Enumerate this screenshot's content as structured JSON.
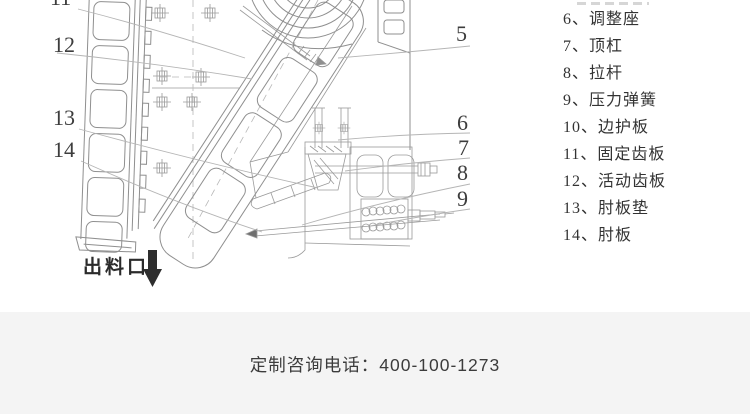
{
  "diagram": {
    "discharge_label": "出料口",
    "callouts": {
      "c5": "5",
      "c6": "6",
      "c7": "7",
      "c8": "8",
      "c9": "9",
      "c11": "11",
      "c12": "12",
      "c13": "13",
      "c14": "14"
    }
  },
  "parts_list": {
    "items": [
      "6、调整座",
      "7、顶杠",
      "8、拉杆",
      "9、压力弹簧",
      "10、边护板",
      "11、固定齿板",
      "12、活动齿板",
      "13、肘板垫",
      "14、肘板"
    ]
  },
  "footer": {
    "phone": "定制咨询电话：400-100-1273"
  },
  "colors": {
    "drawing_line": "#8f8f8f",
    "leader_line": "#b5b5b5",
    "callout_text": "#3d3d3d",
    "list_text": "#333333",
    "footer_background": "#f4f4f4",
    "footer_text": "#3c3c3c",
    "arrow": "#2e2e2e"
  }
}
